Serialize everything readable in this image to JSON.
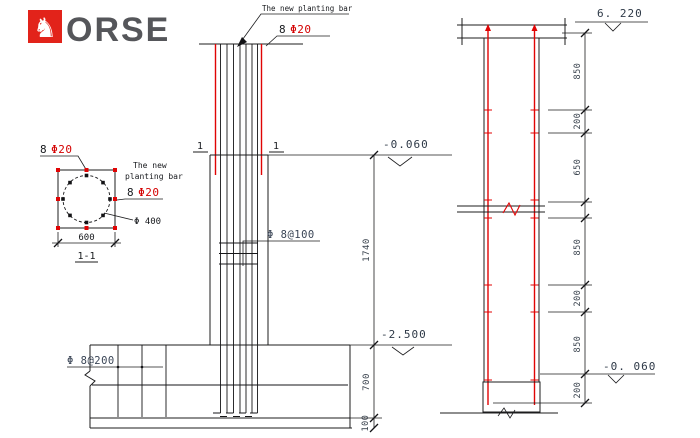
{
  "colors": {
    "accent_red": "#e00404",
    "logo_red": "#e2231a",
    "logo_gray": "#55565a",
    "line_black": "#1c1c1e",
    "dim_text": "#39424d"
  },
  "logo": {
    "brand": "HORSE",
    "letters": "ORSE",
    "horse_head": "♞"
  },
  "section": {
    "bars_count": "8",
    "bars_size": "Φ20",
    "note_line1": "The new",
    "note_line2": "planting bar",
    "right_count": "8",
    "right_size": "Φ20",
    "circle_dia": "Φ 400",
    "width": "600",
    "label": "1-1"
  },
  "elev": {
    "note": "The new planting bar",
    "bars_count": "8",
    "bars_size": "Φ20",
    "cut_left": "1",
    "cut_right": "1",
    "level_joint": "-0.060",
    "stirrups": "Φ 8@100",
    "height": "1740",
    "level_footing": "-2.500",
    "footing_bars": "Φ 8@200",
    "footing_depth": "700",
    "base_depth": "100"
  },
  "right": {
    "level_top": "6. 220",
    "level_bottom": "-0. 060",
    "dims": [
      "850",
      "200",
      "650",
      "850",
      "200",
      "850",
      "200"
    ]
  }
}
